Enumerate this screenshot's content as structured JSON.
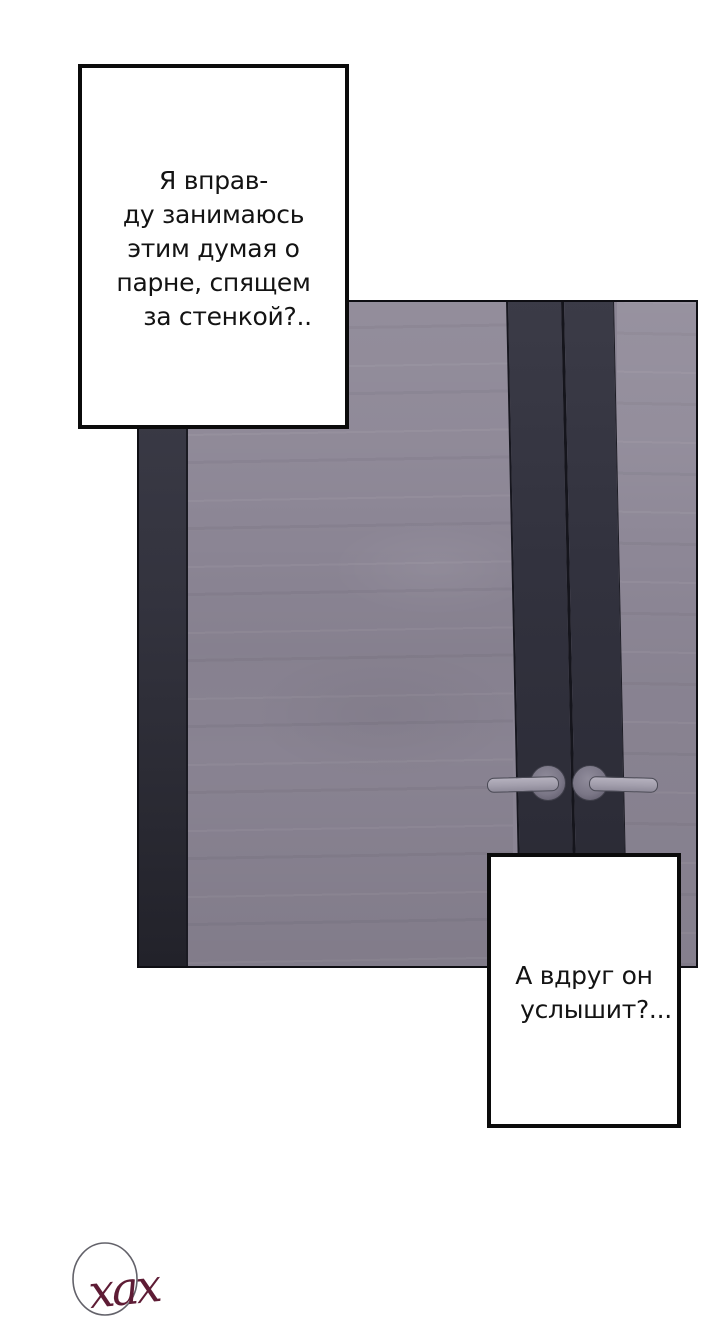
{
  "page": {
    "kind": "webtoon-comic-panel",
    "background_color": "#ffffff"
  },
  "bubbles": {
    "thought_1": {
      "lines": [
        "Я вправ-",
        "ду занимаюсь",
        "этим думая о",
        "парне, спящем",
        "за стенкой?.."
      ]
    },
    "thought_2": {
      "lines": [
        "А вдруг он",
        "услышит?..."
      ]
    }
  },
  "door": {
    "description": "closed double door, dark center stiles and left frame, grey-violet wood panels, two lever handles",
    "panel_color": "#8b8594",
    "stile_color": "#32323e",
    "frame_color": "#33333e",
    "outline_color": "#0e0e13",
    "handle_color": "#a29eac"
  },
  "signature": {
    "text": "хах",
    "ink_color": "#5e1c35",
    "circle_color": "#63626a"
  },
  "text_color": "#131313",
  "bubble_border_color": "#0b0b0b"
}
